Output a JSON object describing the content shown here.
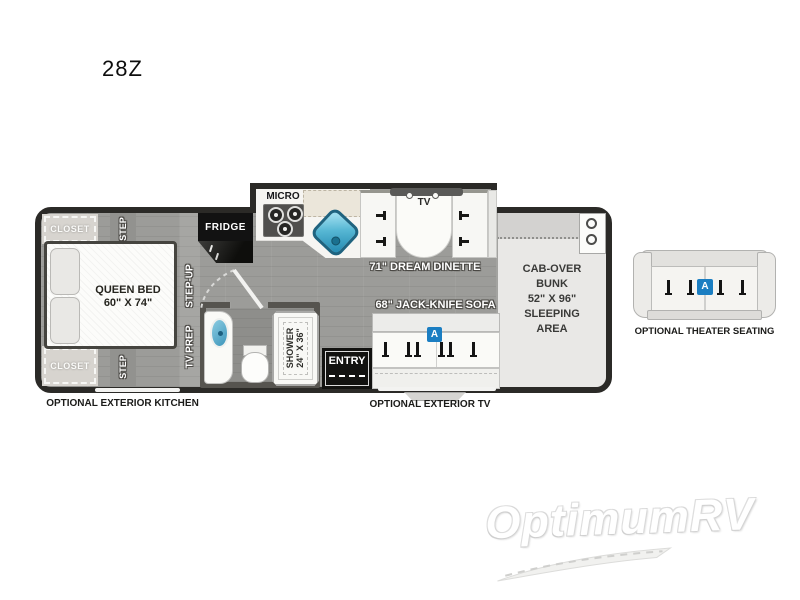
{
  "model": "28Z",
  "plan": {
    "closet_top": "CLOSET",
    "closet_bottom": "CLOSET",
    "step_top": "STEP",
    "step_bottom": "STEP",
    "queen_bed": {
      "line1": "QUEEN BED",
      "line2": "60\" X 74\""
    },
    "step_up": "STEP-UP",
    "tv_prep": "TV PREP",
    "fridge": "FRIDGE",
    "micro": "MICRO",
    "tv": "TV",
    "dinette": "71\" DREAM DINETTE",
    "sofa": "68\" JACK-KNIFE SOFA",
    "sofa_badge": "A",
    "shower": {
      "line1": "SHOWER",
      "line2": "24\" X 36\""
    },
    "entry": "ENTRY",
    "cab_over": {
      "lines": [
        "CAB-OVER",
        "BUNK",
        "52\" X 96\"",
        "SLEEPING",
        "AREA"
      ]
    }
  },
  "exterior": {
    "kitchen_label": "OPTIONAL EXTERIOR KITCHEN",
    "tv_label": "OPTIONAL EXTERIOR TV",
    "theater_label": "OPTIONAL THEATER SEATING",
    "theater_badge": "A"
  },
  "watermark": "OptimumRV",
  "colors": {
    "badge_blue": "#1b7ec2",
    "wall_black": "#2b2a27",
    "floor_gray": "#9c9c99",
    "sink_blue": "#57b7d4"
  }
}
